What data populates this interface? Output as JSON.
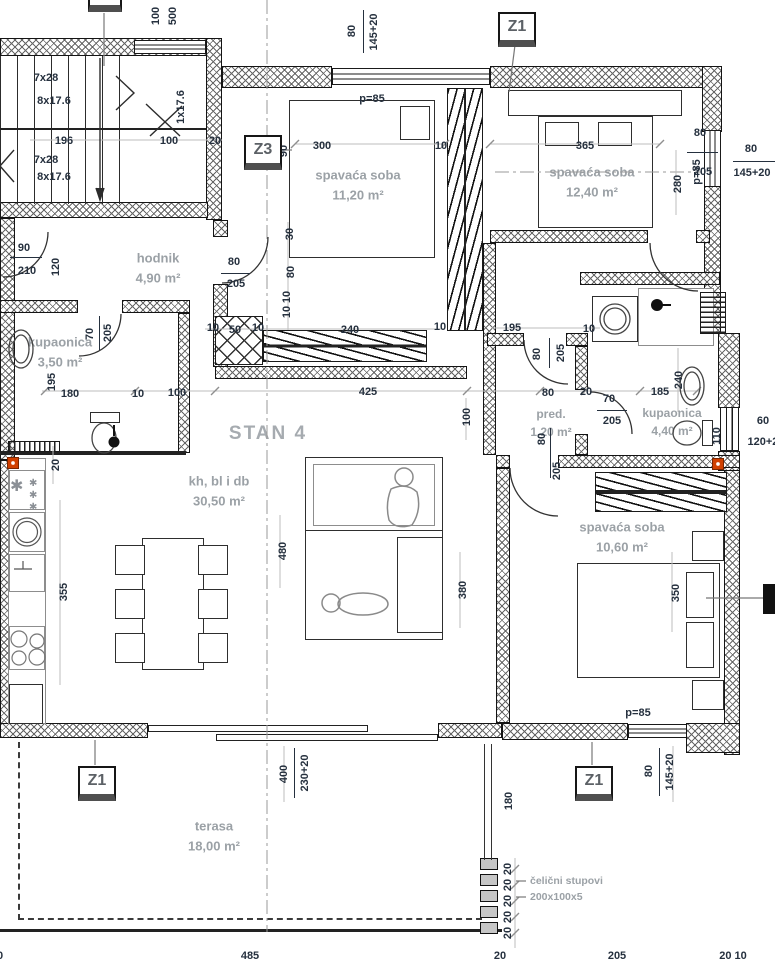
{
  "apartment_label": "STAN 4",
  "colors": {
    "dim_text": "#25303e",
    "room_text": "#9ba1a6",
    "line": "#1a1a1a",
    "accent_red": "#d14000",
    "marker_text": "#5c6166"
  },
  "markers": [
    {
      "label": "Z1"
    },
    {
      "label": "Z3"
    },
    {
      "label": "Z1"
    },
    {
      "label": "Z1"
    }
  ],
  "rooms": [
    {
      "name": "spavaća soba",
      "area": "11,20 m²"
    },
    {
      "name": "spavaća soba",
      "area": "12,40 m²"
    },
    {
      "name": "hodnik",
      "area": "4,90 m²"
    },
    {
      "name": "kupaonica",
      "area": "3,50 m²"
    },
    {
      "name": "pred.",
      "area": "1,20 m²"
    },
    {
      "name": "kupaonica",
      "area": "4,40 m²"
    },
    {
      "name": "spavaća soba",
      "area": "10,60 m²"
    },
    {
      "name": "kh, bl i db",
      "area": "30,50 m²"
    },
    {
      "name": "terasa",
      "area": "18,00 m²"
    }
  ],
  "notes": {
    "columns_line1": "čelični stupovi",
    "columns_line2": "200x100x5"
  },
  "dims": [
    {
      "t": "100",
      "x": 156,
      "y": 16,
      "r": -90
    },
    {
      "t": "500",
      "x": 173,
      "y": 16,
      "r": -90
    },
    {
      "t": "80",
      "x": 352,
      "y": 31,
      "r": -90
    },
    {
      "t": "145+20",
      "x": 374,
      "y": 32,
      "r": -90
    },
    {
      "t": "p=85",
      "x": 372,
      "y": 99,
      "r": 0
    },
    {
      "t": "300",
      "x": 322,
      "y": 146,
      "r": 0
    },
    {
      "t": "90",
      "x": 284,
      "y": 151,
      "r": -90
    },
    {
      "t": "10",
      "x": 441,
      "y": 146,
      "r": 0
    },
    {
      "t": "365",
      "x": 585,
      "y": 146,
      "r": 0
    },
    {
      "t": "280",
      "x": 678,
      "y": 184,
      "r": -90
    },
    {
      "t": "p=85",
      "x": 697,
      "y": 172,
      "r": -90
    },
    {
      "t": "80",
      "x": 751,
      "y": 149,
      "r": 0
    },
    {
      "t": "145+20",
      "x": 752,
      "y": 173,
      "r": 0
    },
    {
      "t": "7x28",
      "x": 46,
      "y": 78,
      "r": 0
    },
    {
      "t": "8x17.6",
      "x": 54,
      "y": 101,
      "r": 0
    },
    {
      "t": "7x28",
      "x": 46,
      "y": 160,
      "r": 0
    },
    {
      "t": "8x17.6",
      "x": 54,
      "y": 177,
      "r": 0
    },
    {
      "t": "1x17.6",
      "x": 181,
      "y": 107,
      "r": -90
    },
    {
      "t": "196",
      "x": 64,
      "y": 141,
      "r": 0
    },
    {
      "t": "100",
      "x": 169,
      "y": 141,
      "r": 0
    },
    {
      "t": "20",
      "x": 215,
      "y": 141,
      "r": 0
    },
    {
      "t": "90",
      "x": 24,
      "y": 248,
      "r": 0
    },
    {
      "t": "210",
      "x": 27,
      "y": 271,
      "r": 0
    },
    {
      "t": "120",
      "x": 56,
      "y": 267,
      "r": -90
    },
    {
      "t": "80",
      "x": 234,
      "y": 262,
      "r": 0
    },
    {
      "t": "205",
      "x": 236,
      "y": 284,
      "r": 0
    },
    {
      "t": "30",
      "x": 290,
      "y": 234,
      "r": -90
    },
    {
      "t": "80",
      "x": 291,
      "y": 272,
      "r": -90
    },
    {
      "t": "10",
      "x": 287,
      "y": 297,
      "r": -90
    },
    {
      "t": "10",
      "x": 287,
      "y": 312,
      "r": -90
    },
    {
      "t": "70",
      "x": 90,
      "y": 334,
      "r": -90
    },
    {
      "t": "205",
      "x": 108,
      "y": 333,
      "r": -90
    },
    {
      "t": "195",
      "x": 52,
      "y": 382,
      "r": -90
    },
    {
      "t": "10",
      "x": 213,
      "y": 328,
      "r": 0
    },
    {
      "t": "50",
      "x": 235,
      "y": 330,
      "r": 0
    },
    {
      "t": "10",
      "x": 258,
      "y": 328,
      "r": 0
    },
    {
      "t": "240",
      "x": 350,
      "y": 330,
      "r": 0
    },
    {
      "t": "10",
      "x": 440,
      "y": 327,
      "r": 0
    },
    {
      "t": "180",
      "x": 70,
      "y": 394,
      "r": 0
    },
    {
      "t": "10",
      "x": 138,
      "y": 394,
      "r": 0
    },
    {
      "t": "100",
      "x": 177,
      "y": 393,
      "r": 0
    },
    {
      "t": "425",
      "x": 368,
      "y": 392,
      "r": 0
    },
    {
      "t": "80",
      "x": 548,
      "y": 393,
      "r": 0
    },
    {
      "t": "20",
      "x": 586,
      "y": 392,
      "r": 0
    },
    {
      "t": "185",
      "x": 660,
      "y": 392,
      "r": 0
    },
    {
      "t": "100",
      "x": 467,
      "y": 417,
      "r": -90
    },
    {
      "t": "195",
      "x": 512,
      "y": 328,
      "r": 0
    },
    {
      "t": "10",
      "x": 589,
      "y": 329,
      "r": 0
    },
    {
      "t": "80",
      "x": 537,
      "y": 354,
      "r": -90
    },
    {
      "t": "205",
      "x": 561,
      "y": 353,
      "r": -90
    },
    {
      "t": "70",
      "x": 609,
      "y": 399,
      "r": 0
    },
    {
      "t": "205",
      "x": 612,
      "y": 421,
      "r": 0
    },
    {
      "t": "240",
      "x": 679,
      "y": 380,
      "r": -90
    },
    {
      "t": "60",
      "x": 763,
      "y": 421,
      "r": 0
    },
    {
      "t": "120+20",
      "x": 766,
      "y": 442,
      "r": 0
    },
    {
      "t": "110",
      "x": 717,
      "y": 436,
      "r": -90
    },
    {
      "t": "80",
      "x": 700,
      "y": 133,
      "r": 0
    },
    {
      "t": "205",
      "x": 703,
      "y": 172,
      "r": 0
    },
    {
      "t": "20",
      "x": 56,
      "y": 465,
      "r": -90
    },
    {
      "t": "355",
      "x": 64,
      "y": 592,
      "r": -90
    },
    {
      "t": "480",
      "x": 283,
      "y": 551,
      "r": -90
    },
    {
      "t": "380",
      "x": 463,
      "y": 590,
      "r": -90
    },
    {
      "t": "350",
      "x": 676,
      "y": 593,
      "r": -90
    },
    {
      "t": "80",
      "x": 542,
      "y": 439,
      "r": -90
    },
    {
      "t": "205",
      "x": 557,
      "y": 471,
      "r": -90
    },
    {
      "t": "p=85",
      "x": 638,
      "y": 713,
      "r": 0
    },
    {
      "t": "400",
      "x": 284,
      "y": 774,
      "r": -90
    },
    {
      "t": "230+20",
      "x": 305,
      "y": 773,
      "r": -90
    },
    {
      "t": "180",
      "x": 509,
      "y": 801,
      "r": -90
    },
    {
      "t": "80",
      "x": 649,
      "y": 771,
      "r": -90
    },
    {
      "t": "145+20",
      "x": 670,
      "y": 772,
      "r": -90
    },
    {
      "t": "20",
      "x": 508,
      "y": 869,
      "r": -90
    },
    {
      "t": "20",
      "x": 508,
      "y": 885,
      "r": -90
    },
    {
      "t": "20",
      "x": 508,
      "y": 901,
      "r": -90
    },
    {
      "t": "20",
      "x": 508,
      "y": 917,
      "r": -90
    },
    {
      "t": "20",
      "x": 508,
      "y": 933,
      "r": -90
    },
    {
      "t": "20",
      "x": -3,
      "y": 956,
      "r": 0
    },
    {
      "t": "485",
      "x": 250,
      "y": 956,
      "r": 0
    },
    {
      "t": "20",
      "x": 500,
      "y": 956,
      "r": 0
    },
    {
      "t": "205",
      "x": 617,
      "y": 956,
      "r": 0
    },
    {
      "t": "20 10",
      "x": 733,
      "y": 956,
      "r": 0
    }
  ]
}
